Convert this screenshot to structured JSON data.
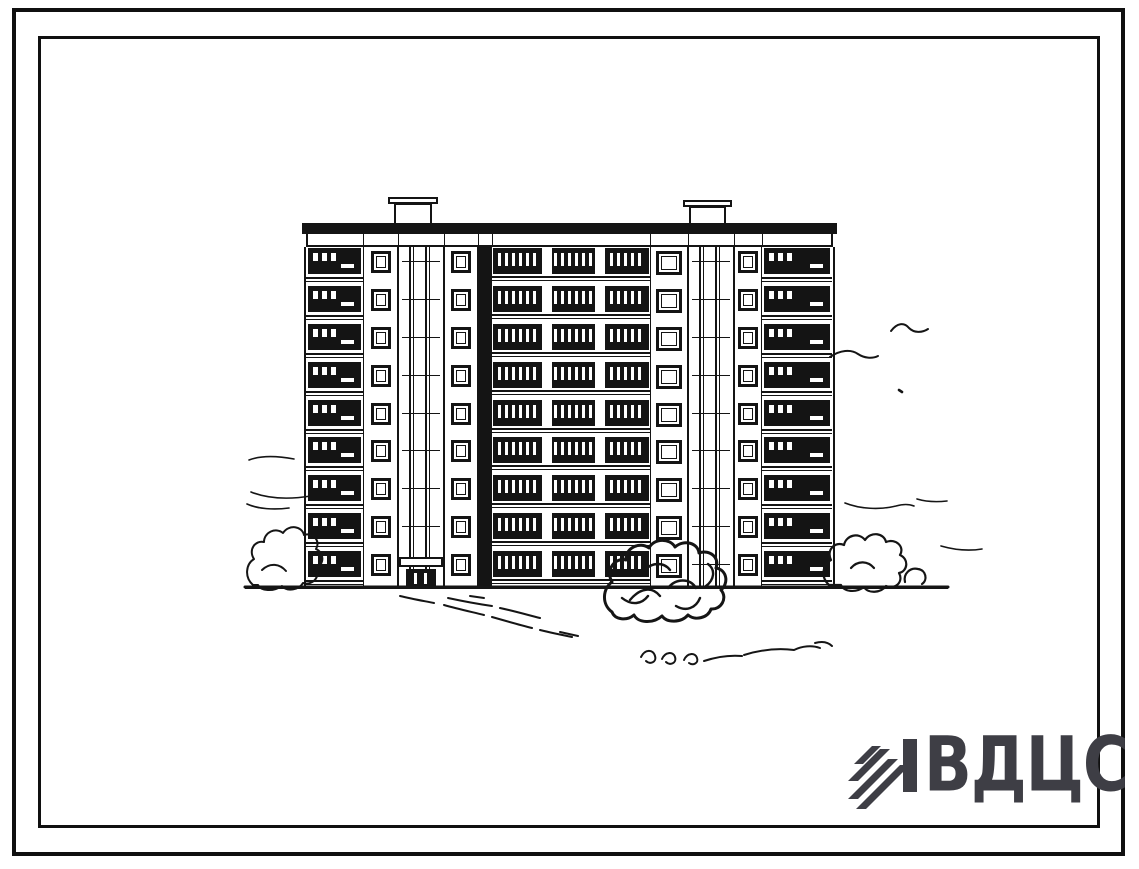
{
  "page": {
    "background": "#ffffff",
    "frame_color": "#101010",
    "ink_color": "#141414"
  },
  "logo": {
    "text": "ВДЦС",
    "color": "#3e3e45",
    "emblem_icon": "diagonal-stripes-mark"
  },
  "drawing": {
    "type": "architectural elevation ink sketch",
    "subject": "nine-storey multi-section prefabricated apartment building, street facade with landscaping",
    "building": {
      "floors": 9,
      "facade": {
        "x": 306,
        "y": 223,
        "width": 527,
        "ground_y": 588,
        "parapet_h": 11,
        "attic_h": 13
      },
      "chimneys": [
        {
          "cap": [
            388,
            197,
            50,
            7
          ],
          "stack": [
            394,
            203,
            38,
            21
          ]
        },
        {
          "cap": [
            683,
            200,
            49,
            7
          ],
          "stack": [
            689,
            206,
            37,
            18
          ]
        }
      ],
      "sections": [
        {
          "type": "loggia",
          "x": 306,
          "w": 57
        },
        {
          "type": "pier",
          "x": 363,
          "w": 35
        },
        {
          "type": "stair",
          "x": 398,
          "w": 46,
          "entrance": true
        },
        {
          "type": "pier",
          "x": 444,
          "w": 34
        },
        {
          "type": "dark",
          "x": 478,
          "w": 14
        },
        {
          "type": "main",
          "x": 492,
          "w": 158,
          "dividers": [
            50,
            103
          ]
        },
        {
          "type": "pier",
          "x": 650,
          "w": 38,
          "big": true
        },
        {
          "type": "stair",
          "x": 688,
          "w": 46
        },
        {
          "type": "pier",
          "x": 734,
          "w": 28
        },
        {
          "type": "loggia",
          "x": 762,
          "w": 70
        }
      ],
      "ground_line": {
        "x1": 245,
        "x2": 948,
        "y": 587
      }
    }
  }
}
